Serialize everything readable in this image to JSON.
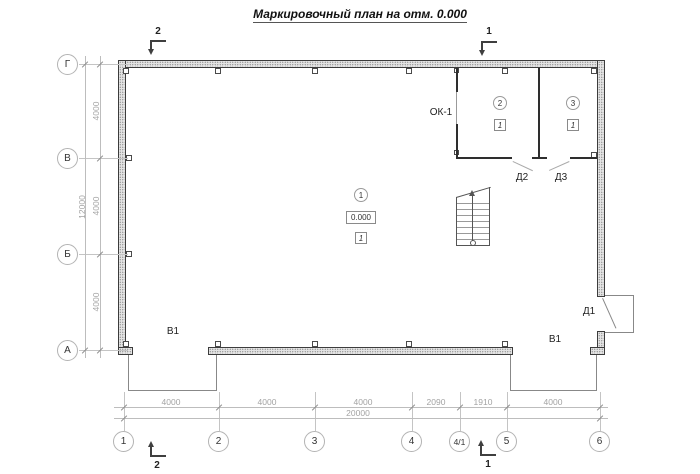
{
  "title": "Маркировочный план на отм. 0.000",
  "axes": {
    "rows": [
      {
        "label": "Г"
      },
      {
        "label": "В"
      },
      {
        "label": "Б"
      },
      {
        "label": "А"
      }
    ],
    "cols": [
      {
        "label": "1"
      },
      {
        "label": "2"
      },
      {
        "label": "3"
      },
      {
        "label": "4"
      },
      {
        "label": "4/1"
      },
      {
        "label": "5"
      },
      {
        "label": "6"
      }
    ]
  },
  "dimensions": {
    "left": {
      "segments": [
        "4000",
        "4000",
        "4000"
      ],
      "total": "12000"
    },
    "bottom": {
      "segments": [
        "4000",
        "4000",
        "4000",
        "2090",
        "1910",
        "4000"
      ],
      "total": "20000"
    }
  },
  "rooms": [
    {
      "number": "1",
      "elevation": "0.000",
      "floor_type": "1"
    },
    {
      "number": "2",
      "floor_type": "1"
    },
    {
      "number": "3",
      "floor_type": "1"
    }
  ],
  "openings": {
    "window_label": "ОК-1",
    "doors": [
      {
        "label": "Д1"
      },
      {
        "label": "Д2"
      },
      {
        "label": "Д3"
      }
    ],
    "inlets": [
      {
        "label": "В1"
      },
      {
        "label": "В1"
      }
    ]
  },
  "section_marks": {
    "top_left": "2",
    "top_right": "1",
    "bottom_left": "2",
    "bottom_right": "1"
  },
  "colors": {
    "wall_outline": "#3c3c3c",
    "wall_fill": "#e3e3e3",
    "construction_line": "#c4c4c4",
    "dim_text": "#a3a3a3",
    "label_text": "#1f1f1f"
  }
}
